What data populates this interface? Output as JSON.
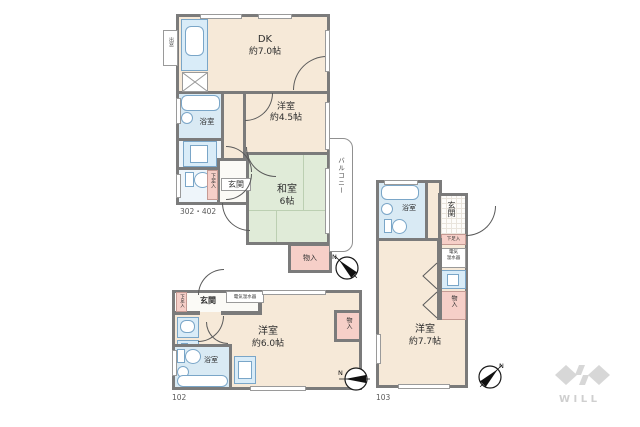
{
  "unit_a": {
    "number": "302・402",
    "dk_name": "DK",
    "dk_size": "約7.0帖",
    "western_name": "洋室",
    "western_size": "約4.5帖",
    "japanese_name": "和室",
    "japanese_size": "6帖",
    "bath": "浴室",
    "entrance": "玄関",
    "shoe_box": "下足入",
    "closet": "物入",
    "balcony": "バルコニー",
    "bay_window": "出窓"
  },
  "unit_b": {
    "number": "102",
    "western_name": "洋室",
    "western_size": "約6.0帖",
    "bath": "浴室",
    "entrance": "玄関",
    "shoe_box": "下足入",
    "water_heater": "電気温水器",
    "closet": "物入"
  },
  "unit_c": {
    "number": "103",
    "western_name": "洋室",
    "western_size": "約7.7帖",
    "bath": "浴室",
    "entrance": "玄関",
    "shoe_box": "下足入",
    "water_heater_line1": "電気",
    "water_heater_line2": "温水器",
    "closet": "物入"
  },
  "compass": {
    "north_label": "N"
  },
  "brand": {
    "logo_text": "WILL"
  }
}
